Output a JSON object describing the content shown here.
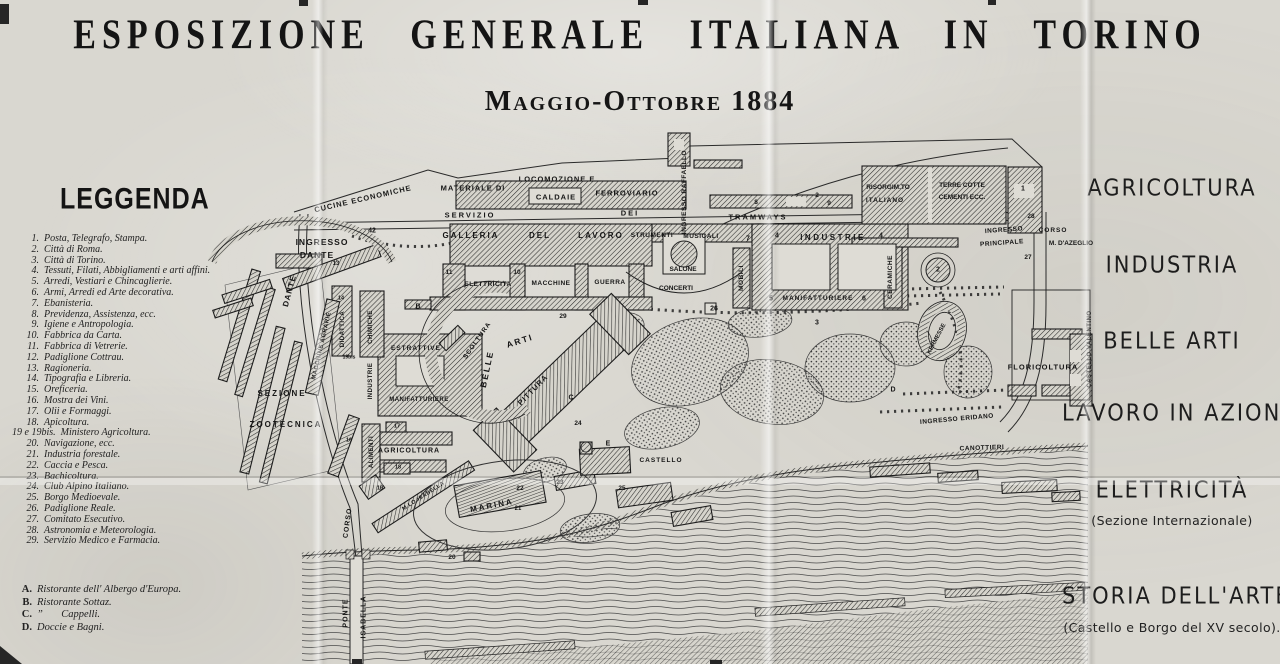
{
  "title": "ESPOSIZIONE GENERALE ITALIANA IN TORINO",
  "subtitle": "Maggio-Ottobre 1884",
  "legend": {
    "heading": "LEGGENDA",
    "items": [
      {
        "num": "1.",
        "text": "Posta, Telegrafo, Stampa."
      },
      {
        "num": "2.",
        "text": "Città di Roma."
      },
      {
        "num": "3.",
        "text": "Città di Torino."
      },
      {
        "num": "4.",
        "text": "Tessuti, Filati, Abbigliamenti e arti affini."
      },
      {
        "num": "5.",
        "text": "Arredi, Vestiari e Chincaglierie."
      },
      {
        "num": "6.",
        "text": "Armi, Arredi ed Arte decorativa."
      },
      {
        "num": "7.",
        "text": "Ebanisteria."
      },
      {
        "num": "8.",
        "text": "Previdenza, Assistenza, ecc."
      },
      {
        "num": "9.",
        "text": "Igiene e Antropologia."
      },
      {
        "num": "10.",
        "text": "Fabbrica da Carta."
      },
      {
        "num": "11.",
        "text": "Fabbrica di Vetrerie."
      },
      {
        "num": "12.",
        "text": "Padiglione Cottrau."
      },
      {
        "num": "13.",
        "text": "Ragioneria."
      },
      {
        "num": "14.",
        "text": "Tipografia e Libreria."
      },
      {
        "num": "15.",
        "text": "Oreficeria."
      },
      {
        "num": "16.",
        "text": "Mostra dei Vini."
      },
      {
        "num": "17.",
        "text": "Olii e Formaggi."
      },
      {
        "num": "18.",
        "text": "Apicoltura."
      },
      {
        "num": "19 e 19bis.",
        "text": "Ministero Agricoltura."
      },
      {
        "num": "20.",
        "text": "Navigazione, ecc."
      },
      {
        "num": "21.",
        "text": "Industria forestale."
      },
      {
        "num": "22.",
        "text": "Caccia e Pesca."
      },
      {
        "num": "23.",
        "text": "Bachicoltura."
      },
      {
        "num": "24.",
        "text": "Club Alpino Italiano."
      },
      {
        "num": "25.",
        "text": "Borgo Medioevale."
      },
      {
        "num": "26.",
        "text": "Padiglione Reale."
      },
      {
        "num": "27.",
        "text": "Comitato Esecutivo."
      },
      {
        "num": "28.",
        "text": "Astronomia e Meteorologia."
      },
      {
        "num": "29.",
        "text": "Servizio Medico e Farmacia."
      }
    ],
    "letter_items": [
      {
        "num": "A.",
        "text": "Ristorante dell' Albergo d'Europa."
      },
      {
        "num": "B.",
        "text": "Ristorante Sottaz."
      },
      {
        "num": "C.",
        "text": "”       Cappelli."
      },
      {
        "num": "D.",
        "text": "Doccie e Bagni."
      }
    ]
  },
  "sections": [
    {
      "label": "AGRICOLTURA",
      "sub": ""
    },
    {
      "label": "INDUSTRIA",
      "sub": ""
    },
    {
      "label": "BELLE ARTI",
      "sub": ""
    },
    {
      "label": "LAVORO IN AZIONE",
      "sub": ""
    },
    {
      "label": "ELETTRICITÀ",
      "sub": "(Sezione Internazionale)"
    },
    {
      "label": "STORIA DELL'ARTE",
      "sub": "(Castello e Borgo del XV secolo)."
    }
  ],
  "map": {
    "labels": [
      {
        "t": "CUCINE ECONOMICHE",
        "x": 363,
        "y": 199,
        "r": -13,
        "fs": 7.5,
        "ls": 1
      },
      {
        "t": "INGRESSO",
        "x": 322,
        "y": 242,
        "fs": 8.5,
        "ls": 1
      },
      {
        "t": "DANTE",
        "x": 317,
        "y": 255,
        "fs": 8.5,
        "ls": 1
      },
      {
        "t": "42",
        "x": 372,
        "y": 231,
        "fs": 7
      },
      {
        "t": "DANTE",
        "x": 290,
        "y": 291,
        "r": -75,
        "fs": 8,
        "ls": 1
      },
      {
        "t": "MATERIALE DI",
        "x": 473,
        "y": 188,
        "fs": 7.5,
        "ls": 1
      },
      {
        "t": "LOCOMOZIONE E",
        "x": 557,
        "y": 179,
        "fs": 7.5,
        "ls": 1
      },
      {
        "t": "CALDAIE",
        "x": 556,
        "y": 197,
        "fs": 7.5,
        "ls": 1
      },
      {
        "t": "FERROVIARIO",
        "x": 627,
        "y": 193,
        "fs": 7.5,
        "ls": 1
      },
      {
        "t": "SERVIZIO",
        "x": 470,
        "y": 215,
        "fs": 7.5,
        "ls": 2
      },
      {
        "t": "DEI",
        "x": 630,
        "y": 213,
        "fs": 7.5,
        "ls": 2
      },
      {
        "t": "TRAMWAYS",
        "x": 758,
        "y": 217,
        "fs": 7.5,
        "ls": 2
      },
      {
        "t": "INGRESSO RAFFAELLO",
        "x": 685,
        "y": 192,
        "r": -90,
        "fs": 6.5,
        "ls": 0.5
      },
      {
        "t": "GALLERIA",
        "x": 471,
        "y": 236,
        "fs": 8,
        "ls": 2
      },
      {
        "t": "DEL",
        "x": 540,
        "y": 236,
        "fs": 8,
        "ls": 2
      },
      {
        "t": "LAVORO",
        "x": 601,
        "y": 236,
        "fs": 8,
        "ls": 2
      },
      {
        "t": "STRUMENTI",
        "x": 652,
        "y": 236,
        "fs": 6.5,
        "ls": 0.5
      },
      {
        "t": "MUSICALI",
        "x": 701,
        "y": 237,
        "fs": 6.5,
        "ls": 0.5
      },
      {
        "t": "ELETTRICITA",
        "x": 488,
        "y": 285,
        "fs": 6.5,
        "ls": 0.5
      },
      {
        "t": "MACCHINE",
        "x": 551,
        "y": 284,
        "fs": 6.5,
        "ls": 0.5
      },
      {
        "t": "GUERRA",
        "x": 610,
        "y": 283,
        "fs": 6.5,
        "ls": 0.5
      },
      {
        "t": "11",
        "x": 449,
        "y": 273,
        "fs": 6.5
      },
      {
        "t": "10",
        "x": 517,
        "y": 273,
        "fs": 6.5
      },
      {
        "t": "SALONE",
        "x": 683,
        "y": 270,
        "fs": 6.5
      },
      {
        "t": "CONCERTI",
        "x": 676,
        "y": 289,
        "fs": 6.5
      },
      {
        "t": "MOBILI",
        "x": 742,
        "y": 278,
        "r": -90,
        "fs": 6.5,
        "ls": 0.5
      },
      {
        "t": "7",
        "x": 748,
        "y": 239,
        "fs": 7
      },
      {
        "t": "4",
        "x": 777,
        "y": 236,
        "fs": 7
      },
      {
        "t": "INDUSTRIE",
        "x": 833,
        "y": 238,
        "fs": 8,
        "ls": 2.5
      },
      {
        "t": "4",
        "x": 881,
        "y": 236,
        "fs": 7
      },
      {
        "t": "5",
        "x": 771,
        "y": 299,
        "fs": 7
      },
      {
        "t": "MANIFATTURIERE",
        "x": 818,
        "y": 299,
        "fs": 6.5,
        "ls": 1
      },
      {
        "t": "6",
        "x": 864,
        "y": 299,
        "fs": 7
      },
      {
        "t": "CERAMICHE",
        "x": 891,
        "y": 277,
        "r": -90,
        "fs": 6.5,
        "ls": 0.5
      },
      {
        "t": "26",
        "x": 714,
        "y": 309,
        "fs": 7
      },
      {
        "t": "3",
        "x": 817,
        "y": 323,
        "fs": 7
      },
      {
        "t": "8",
        "x": 756,
        "y": 203,
        "fs": 6.5
      },
      {
        "t": "2",
        "x": 817,
        "y": 196,
        "fs": 6.5
      },
      {
        "t": "9",
        "x": 829,
        "y": 204,
        "fs": 6.5
      },
      {
        "t": "RISORGIM.TO",
        "x": 888,
        "y": 188,
        "fs": 6.5
      },
      {
        "t": "ITALIANO",
        "x": 885,
        "y": 201,
        "fs": 6.5,
        "ls": 1
      },
      {
        "t": "TERRE COTTE",
        "x": 962,
        "y": 186,
        "fs": 6.5
      },
      {
        "t": "CEMENTI ECC.",
        "x": 962,
        "y": 198,
        "fs": 6.5
      },
      {
        "t": "1",
        "x": 1023,
        "y": 189,
        "fs": 7
      },
      {
        "t": "28",
        "x": 1031,
        "y": 217,
        "fs": 6.5
      },
      {
        "t": "INGRESSO",
        "x": 1004,
        "y": 231,
        "r": -4,
        "fs": 6.5,
        "ls": 0.5
      },
      {
        "t": "PRINCIPALE",
        "x": 1002,
        "y": 244,
        "r": -4,
        "fs": 6.5,
        "ls": 0.5
      },
      {
        "t": "CORSO",
        "x": 1053,
        "y": 231,
        "fs": 6.5,
        "ls": 1
      },
      {
        "t": "M. D'AZEGLIO",
        "x": 1071,
        "y": 244,
        "fs": 6.5
      },
      {
        "t": "27",
        "x": 1028,
        "y": 258,
        "fs": 6.5
      },
      {
        "t": "2",
        "x": 938,
        "y": 270,
        "fs": 7
      },
      {
        "t": "KERMESSE",
        "x": 937,
        "y": 339,
        "r": -62,
        "fs": 6
      },
      {
        "t": "FLORICOLTURA",
        "x": 1043,
        "y": 367,
        "fs": 7.5,
        "ls": 1
      },
      {
        "t": "CASTELLO VALENTINO",
        "x": 1090,
        "y": 349,
        "r": -90,
        "fs": 6,
        "ls": 0.5
      },
      {
        "t": "INGRESSO ERIDANO",
        "x": 957,
        "y": 420,
        "r": -5,
        "fs": 6.5,
        "ls": 0.5
      },
      {
        "t": "CANOTTIERI",
        "x": 982,
        "y": 449,
        "r": -2,
        "fs": 6.5,
        "ls": 0.5
      },
      {
        "t": "D",
        "x": 893,
        "y": 390,
        "fs": 7
      },
      {
        "t": "B",
        "x": 418,
        "y": 307,
        "fs": 7
      },
      {
        "t": "29",
        "x": 563,
        "y": 317,
        "fs": 6.5
      },
      {
        "t": "SCOLTURA",
        "x": 478,
        "y": 341,
        "r": -55,
        "fs": 6.5,
        "ls": 1
      },
      {
        "t": "BELLE",
        "x": 487,
        "y": 369,
        "r": -78,
        "fs": 8.5,
        "ls": 2
      },
      {
        "t": "ARTI",
        "x": 520,
        "y": 341,
        "r": -18,
        "fs": 8.5,
        "ls": 2
      },
      {
        "t": "PITTURA",
        "x": 533,
        "y": 390,
        "r": -46,
        "fs": 7.5,
        "ls": 1
      },
      {
        "t": "C",
        "x": 571,
        "y": 398,
        "fs": 7
      },
      {
        "t": "24",
        "x": 578,
        "y": 424,
        "fs": 6.5
      },
      {
        "t": "E",
        "x": 608,
        "y": 444,
        "fs": 7
      },
      {
        "t": "CASTELLO",
        "x": 661,
        "y": 461,
        "fs": 6.5,
        "ls": 1
      },
      {
        "t": "25",
        "x": 622,
        "y": 489,
        "fs": 6.5
      },
      {
        "t": "ESTRATTIVE",
        "x": 416,
        "y": 349,
        "fs": 6.5,
        "ls": 1
      },
      {
        "t": "MANIFATTURIERE",
        "x": 419,
        "y": 400,
        "fs": 6,
        "ls": 0.5
      },
      {
        "t": "INDUSTRIE",
        "x": 371,
        "y": 381,
        "r": -90,
        "fs": 6,
        "ls": 0.5
      },
      {
        "t": "CHIMICHE",
        "x": 371,
        "y": 327,
        "r": -90,
        "fs": 6,
        "ls": 0.5
      },
      {
        "t": "DIDATTICA",
        "x": 343,
        "y": 329,
        "r": -90,
        "fs": 6,
        "ls": 0.5
      },
      {
        "t": "14",
        "x": 341,
        "y": 299,
        "fs": 5.5
      },
      {
        "t": "19bis",
        "x": 349,
        "y": 358,
        "fs": 5
      },
      {
        "t": "13",
        "x": 336,
        "y": 264,
        "fs": 6
      },
      {
        "t": "MACCHINE AGRARIE",
        "x": 322,
        "y": 346,
        "r": -77,
        "fs": 6,
        "ls": 0.5
      },
      {
        "t": "SEZIONE",
        "x": 282,
        "y": 394,
        "fs": 8,
        "ls": 2
      },
      {
        "t": "ZOOTECNICA",
        "x": 286,
        "y": 425,
        "fs": 8,
        "ls": 2
      },
      {
        "t": "ALIMENTI",
        "x": 372,
        "y": 452,
        "r": -90,
        "fs": 6,
        "ls": 0.5
      },
      {
        "t": "AGRICOLTURA",
        "x": 409,
        "y": 451,
        "fs": 7,
        "ls": 1
      },
      {
        "t": "17",
        "x": 397,
        "y": 427,
        "fs": 5.5
      },
      {
        "t": "18",
        "x": 398,
        "y": 468,
        "fs": 5.5
      },
      {
        "t": "19",
        "x": 380,
        "y": 489,
        "fs": 5.5
      },
      {
        "t": "16",
        "x": 349,
        "y": 441,
        "fs": 5.5
      },
      {
        "t": "CORSO",
        "x": 348,
        "y": 523,
        "r": -82,
        "fs": 7,
        "ls": 1
      },
      {
        "t": "PONTE",
        "x": 346,
        "y": 613,
        "r": -90,
        "fs": 7,
        "ls": 1
      },
      {
        "t": "ISABELLA",
        "x": 364,
        "y": 617,
        "r": -90,
        "fs": 7,
        "ls": 1
      },
      {
        "t": "M.LO ISABELLA",
        "x": 424,
        "y": 497,
        "r": -33,
        "fs": 5.5,
        "ls": 0.5
      },
      {
        "t": "MARINA",
        "x": 492,
        "y": 506,
        "r": -11,
        "fs": 8,
        "ls": 2
      },
      {
        "t": "21",
        "x": 518,
        "y": 509,
        "fs": 6
      },
      {
        "t": "22",
        "x": 520,
        "y": 489,
        "fs": 6.5
      },
      {
        "t": "23",
        "x": 560,
        "y": 483,
        "fs": 6.5
      },
      {
        "t": "20",
        "x": 452,
        "y": 558,
        "fs": 6.5
      }
    ]
  }
}
